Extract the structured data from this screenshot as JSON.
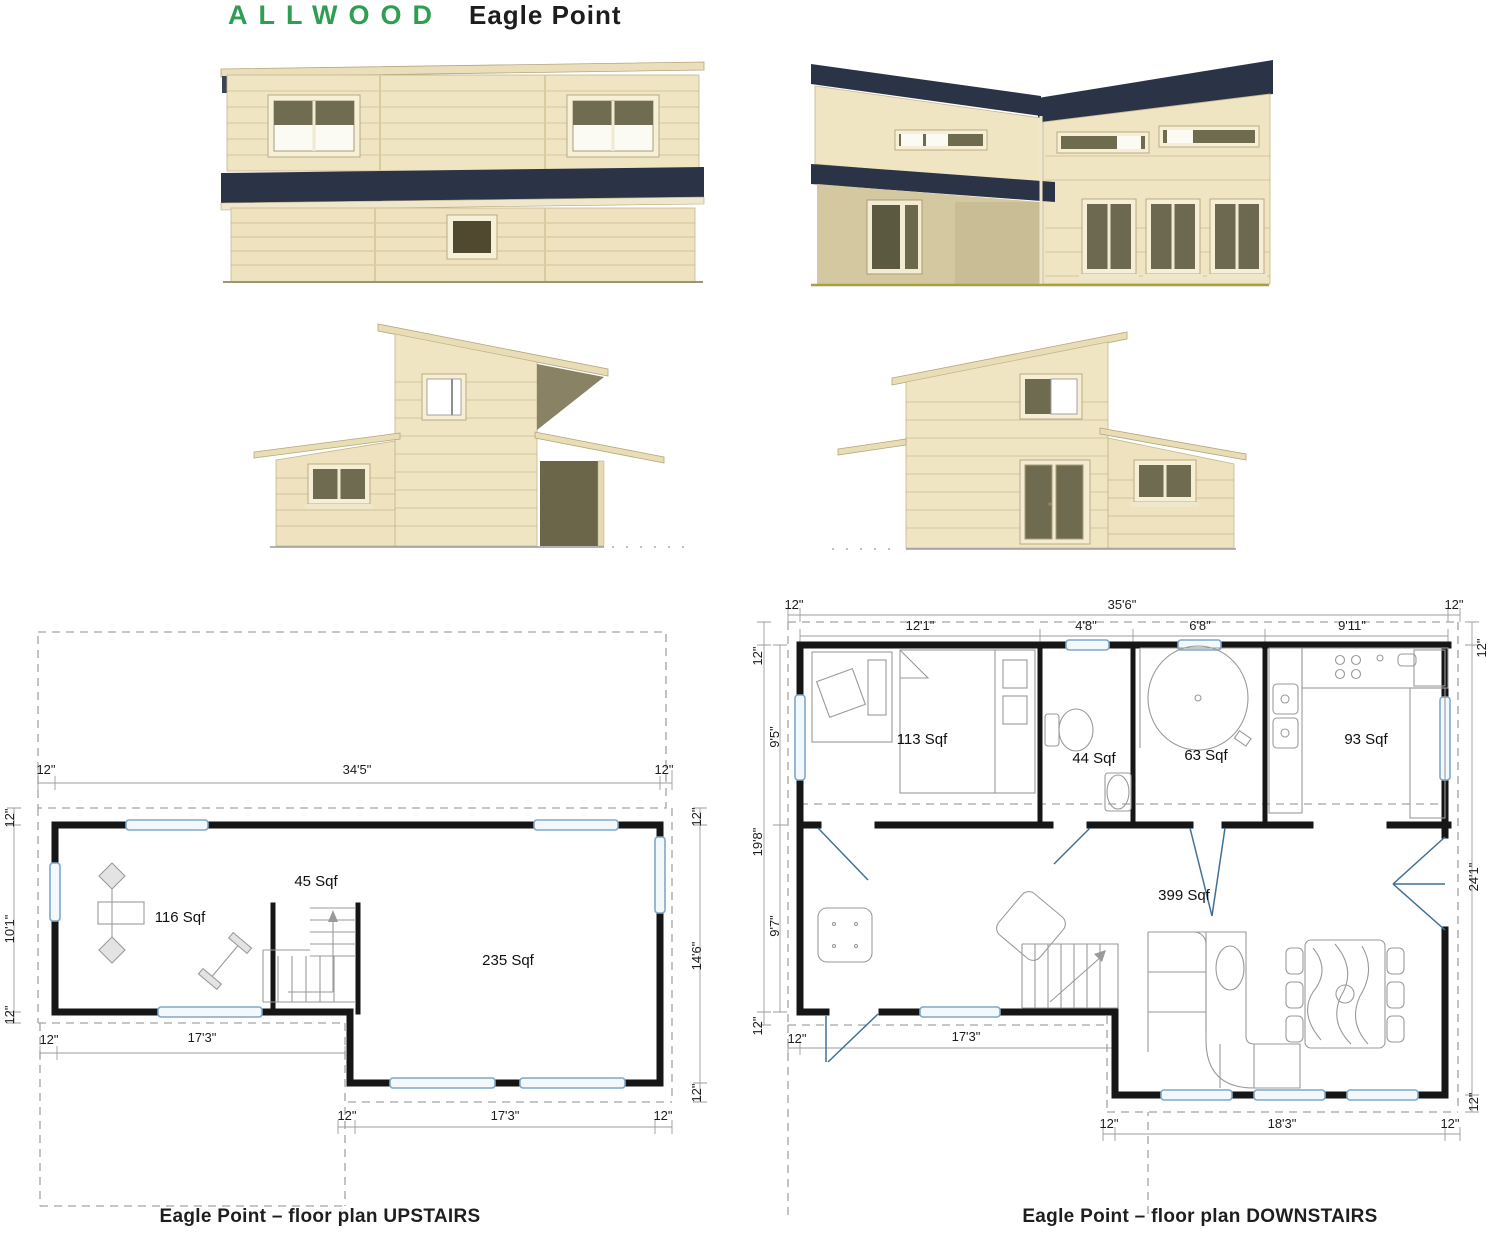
{
  "header": {
    "brand": "ALLWOOD",
    "product": "Eagle Point"
  },
  "palette": {
    "brand_green": "#2f9e53",
    "roof_navy": "#2b3347",
    "wall_beige": "#f0e5c3",
    "glass_olive": "#6f6b50",
    "window_blue": "#7fa8c9",
    "plan_wall_black": "#161616",
    "dim_gray": "#9c9c9c"
  },
  "plans": {
    "upstairs": {
      "caption": "Eagle Point – floor plan UPSTAIRS",
      "rooms": {
        "gym": "116 Sqf",
        "stair_hall": "45 Sqf",
        "loft": "235 Sqf"
      },
      "dims": {
        "overhang": "12\"",
        "top_span": "34'5\"",
        "left_span": "10'1\"",
        "right_span": "14'6\"",
        "mid_span": "17'3\"",
        "bottom_span": "17'3\""
      }
    },
    "downstairs": {
      "caption": "Eagle Point – floor plan DOWNSTAIRS",
      "rooms": {
        "bedroom": "113 Sqf",
        "wc": "44 Sqf",
        "bathroom": "63 Sqf",
        "kitchen": "93 Sqf",
        "living": "399 Sqf"
      },
      "dims": {
        "overhang": "12\"",
        "top_total": "35'6\"",
        "seg_bedroom": "12'1\"",
        "seg_wc": "4'8\"",
        "seg_bath": "6'8\"",
        "seg_kitchen": "9'11\"",
        "left_total": "19'8\"",
        "left_upper": "9'5\"",
        "left_lower": "9'7\"",
        "right_total": "24'1\"",
        "bottom_left_span": "17'3\"",
        "bottom_right_span": "18'3\""
      }
    }
  }
}
